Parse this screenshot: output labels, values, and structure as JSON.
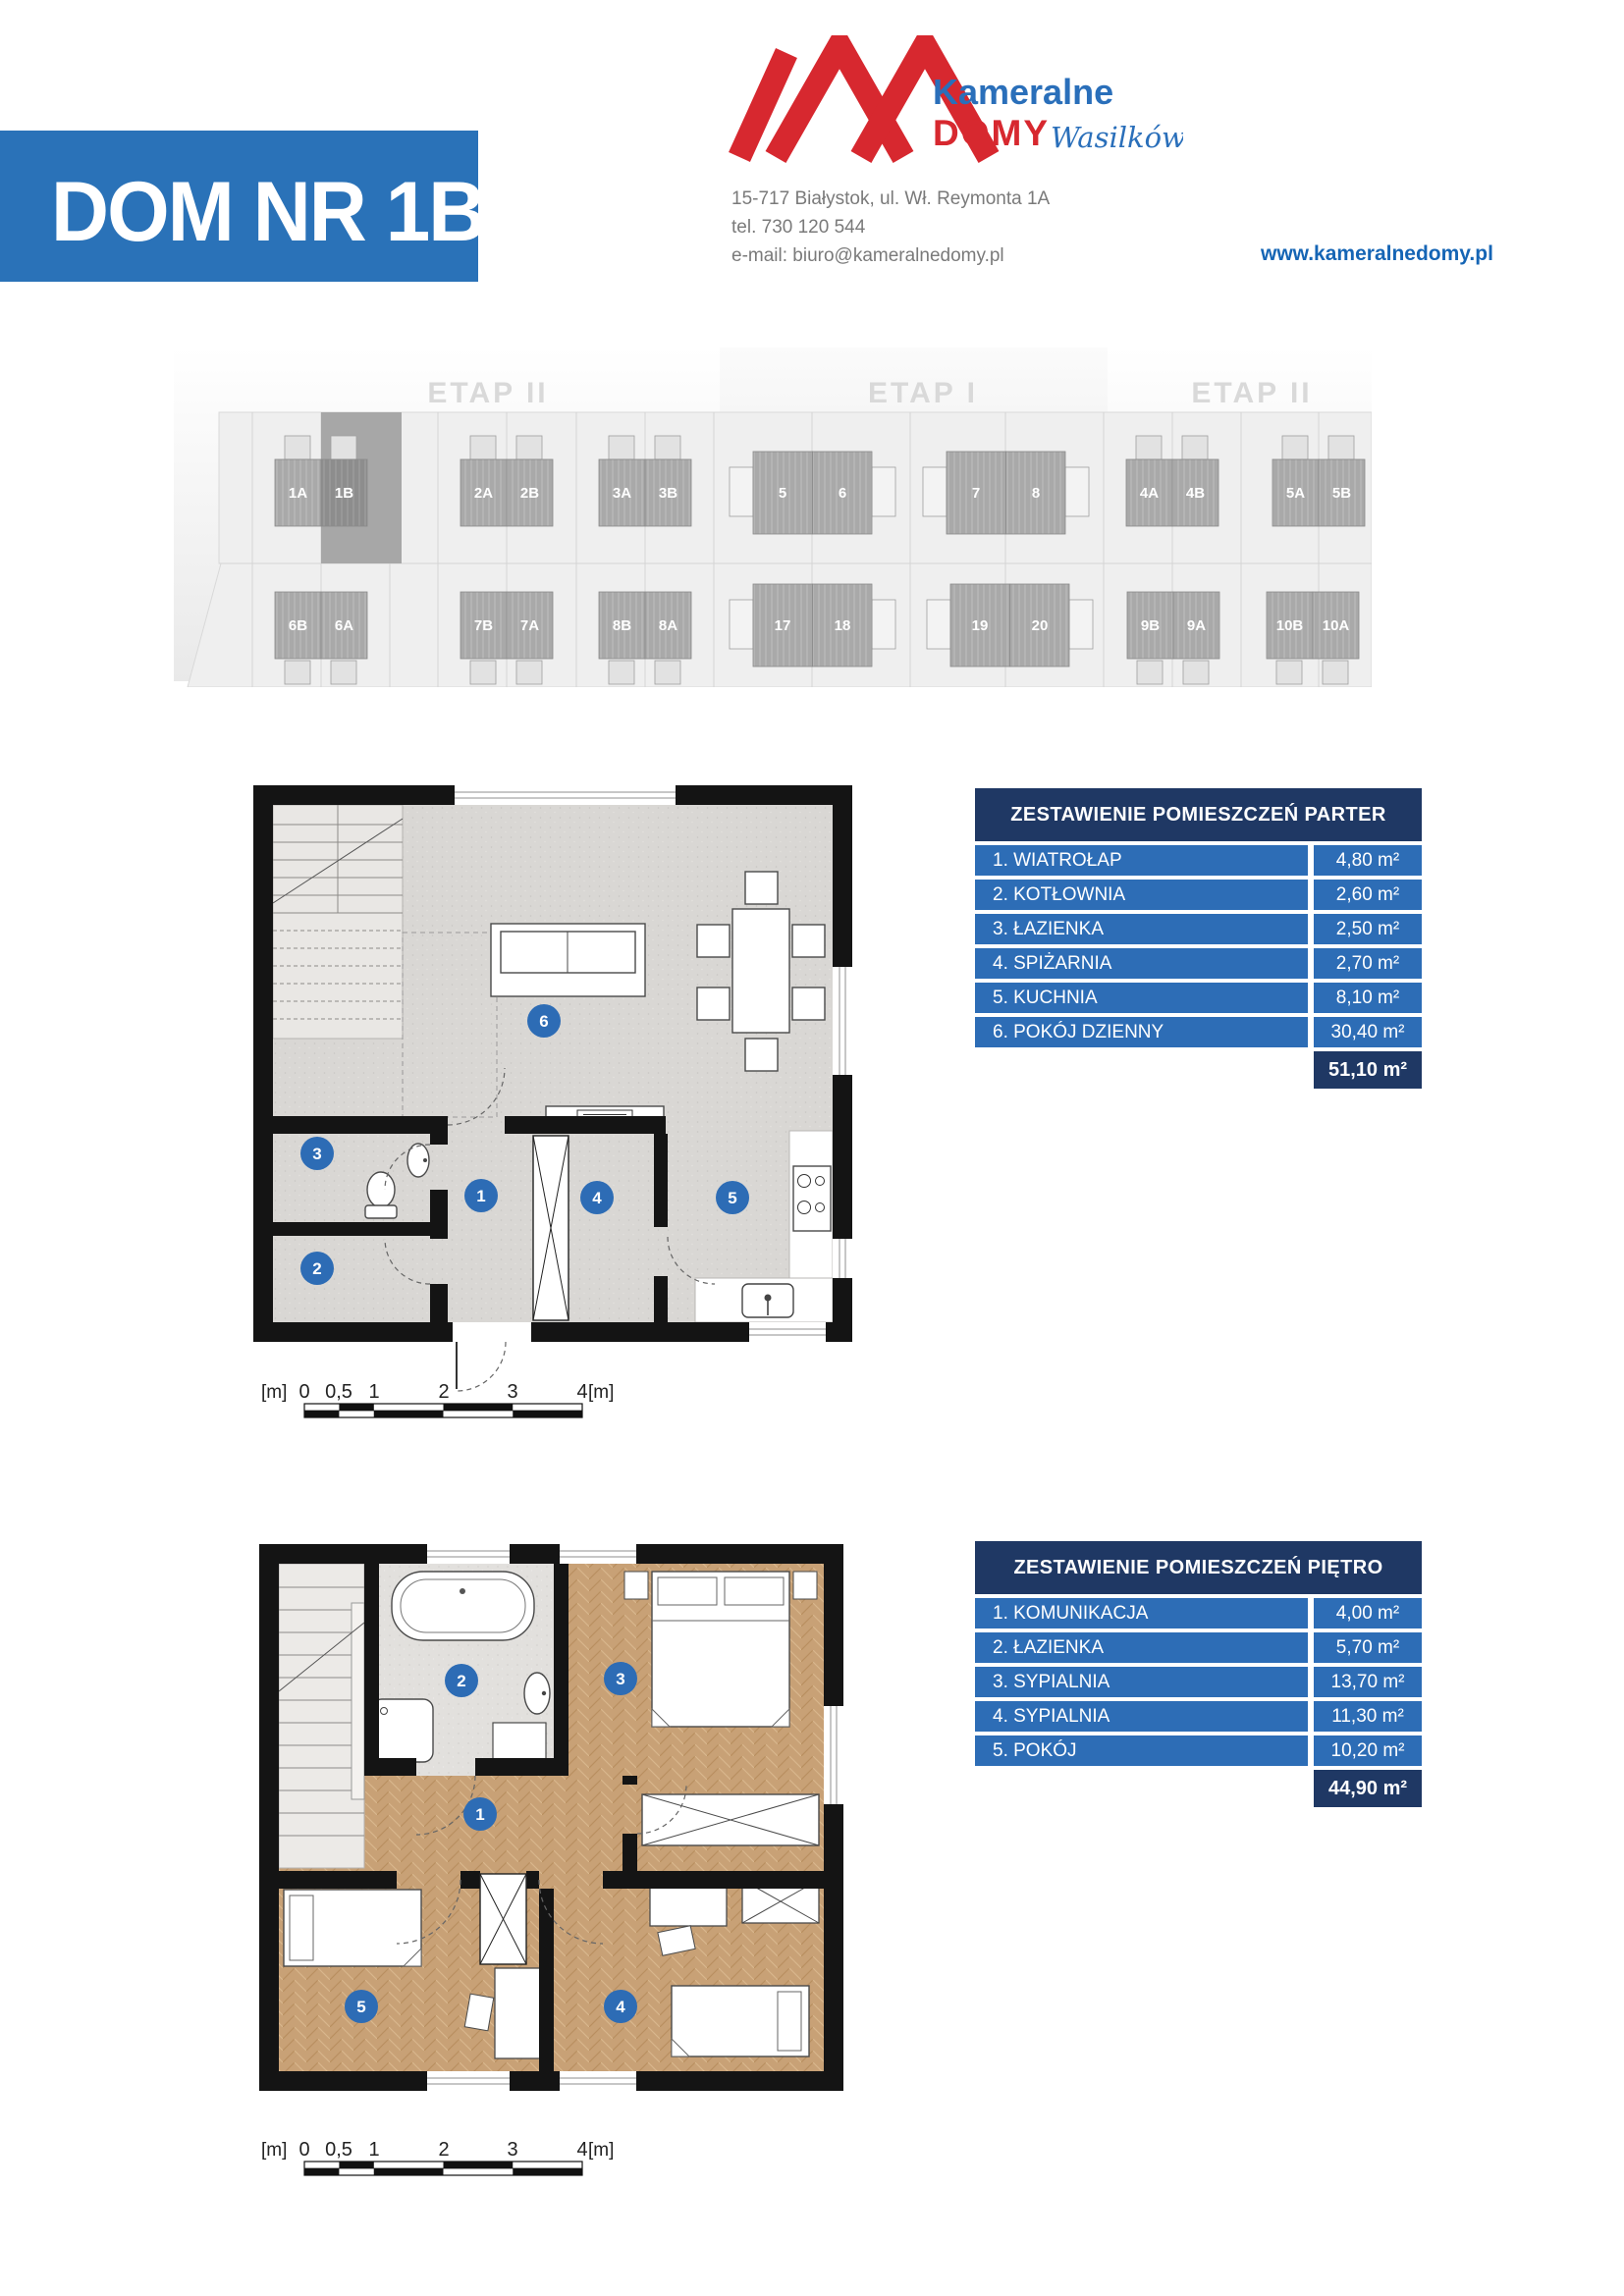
{
  "header": {
    "house_title": "DOM NR 1B",
    "logo": {
      "name_top": "Kameralne",
      "name_bottom": "DOMY",
      "name_script": "Wasilków"
    },
    "contact": {
      "address": "15-717 Białystok, ul. Wł. Reymonta 1A",
      "phone": "tel. 730 120 544",
      "email": "e-mail: biuro@kameralnedomy.pl",
      "website": "www.kameralnedomy.pl"
    }
  },
  "site_plan": {
    "sections": [
      "ETAP II",
      "ETAP I",
      "ETAP II"
    ],
    "highlighted_house": "1B",
    "top_row": [
      "1A",
      "1B",
      "2A",
      "2B",
      "3A",
      "3B",
      "5",
      "6",
      "7",
      "8",
      "4A",
      "4B",
      "5A",
      "5B"
    ],
    "bottom_row": [
      "6B",
      "6A",
      "7B",
      "7A",
      "8B",
      "8A",
      "17",
      "18",
      "19",
      "20",
      "9B",
      "9A",
      "10B",
      "10A"
    ]
  },
  "tables": {
    "parter": {
      "title": "ZESTAWIENIE POMIESZCZEŃ PARTER",
      "rows": [
        {
          "label": "1. WIATROŁAP",
          "area": "4,80 m²"
        },
        {
          "label": "2. KOTŁOWNIA",
          "area": "2,60 m²"
        },
        {
          "label": "3. ŁAZIENKA",
          "area": "2,50 m²"
        },
        {
          "label": "4. SPIŻARNIA",
          "area": "2,70 m²"
        },
        {
          "label": "5. KUCHNIA",
          "area": "8,10 m²"
        },
        {
          "label": "6. POKÓJ DZIENNY",
          "area": "30,40 m²"
        }
      ],
      "total": "51,10 m²"
    },
    "pietro": {
      "title": "ZESTAWIENIE POMIESZCZEŃ PIĘTRO",
      "rows": [
        {
          "label": "1. KOMUNIKACJA",
          "area": "4,00 m²"
        },
        {
          "label": "2. ŁAZIENKA",
          "area": "5,70 m²"
        },
        {
          "label": "3. SYPIALNIA",
          "area": "13,70 m²"
        },
        {
          "label": "4. SYPIALNIA",
          "area": "11,30 m²"
        },
        {
          "label": "5. POKÓJ",
          "area": "10,20 m²"
        }
      ],
      "total": "44,90 m²"
    }
  },
  "floor_plans": {
    "parter": {
      "room_numbers": [
        "1",
        "2",
        "3",
        "4",
        "5",
        "6"
      ]
    },
    "pietro": {
      "room_numbers": [
        "1",
        "2",
        "3",
        "4",
        "5"
      ]
    }
  },
  "scale_bar": {
    "unit": "[m]",
    "ticks": [
      "0",
      "0,5",
      "1",
      "2",
      "3",
      "4"
    ]
  },
  "colors": {
    "brand_blue": "#2a72b8",
    "table_row_blue": "#2d6db6",
    "table_navy": "#1f3864",
    "logo_red": "#d7282f",
    "logo_blue": "#2a6fba",
    "marker_blue": "#2d6cb5"
  }
}
